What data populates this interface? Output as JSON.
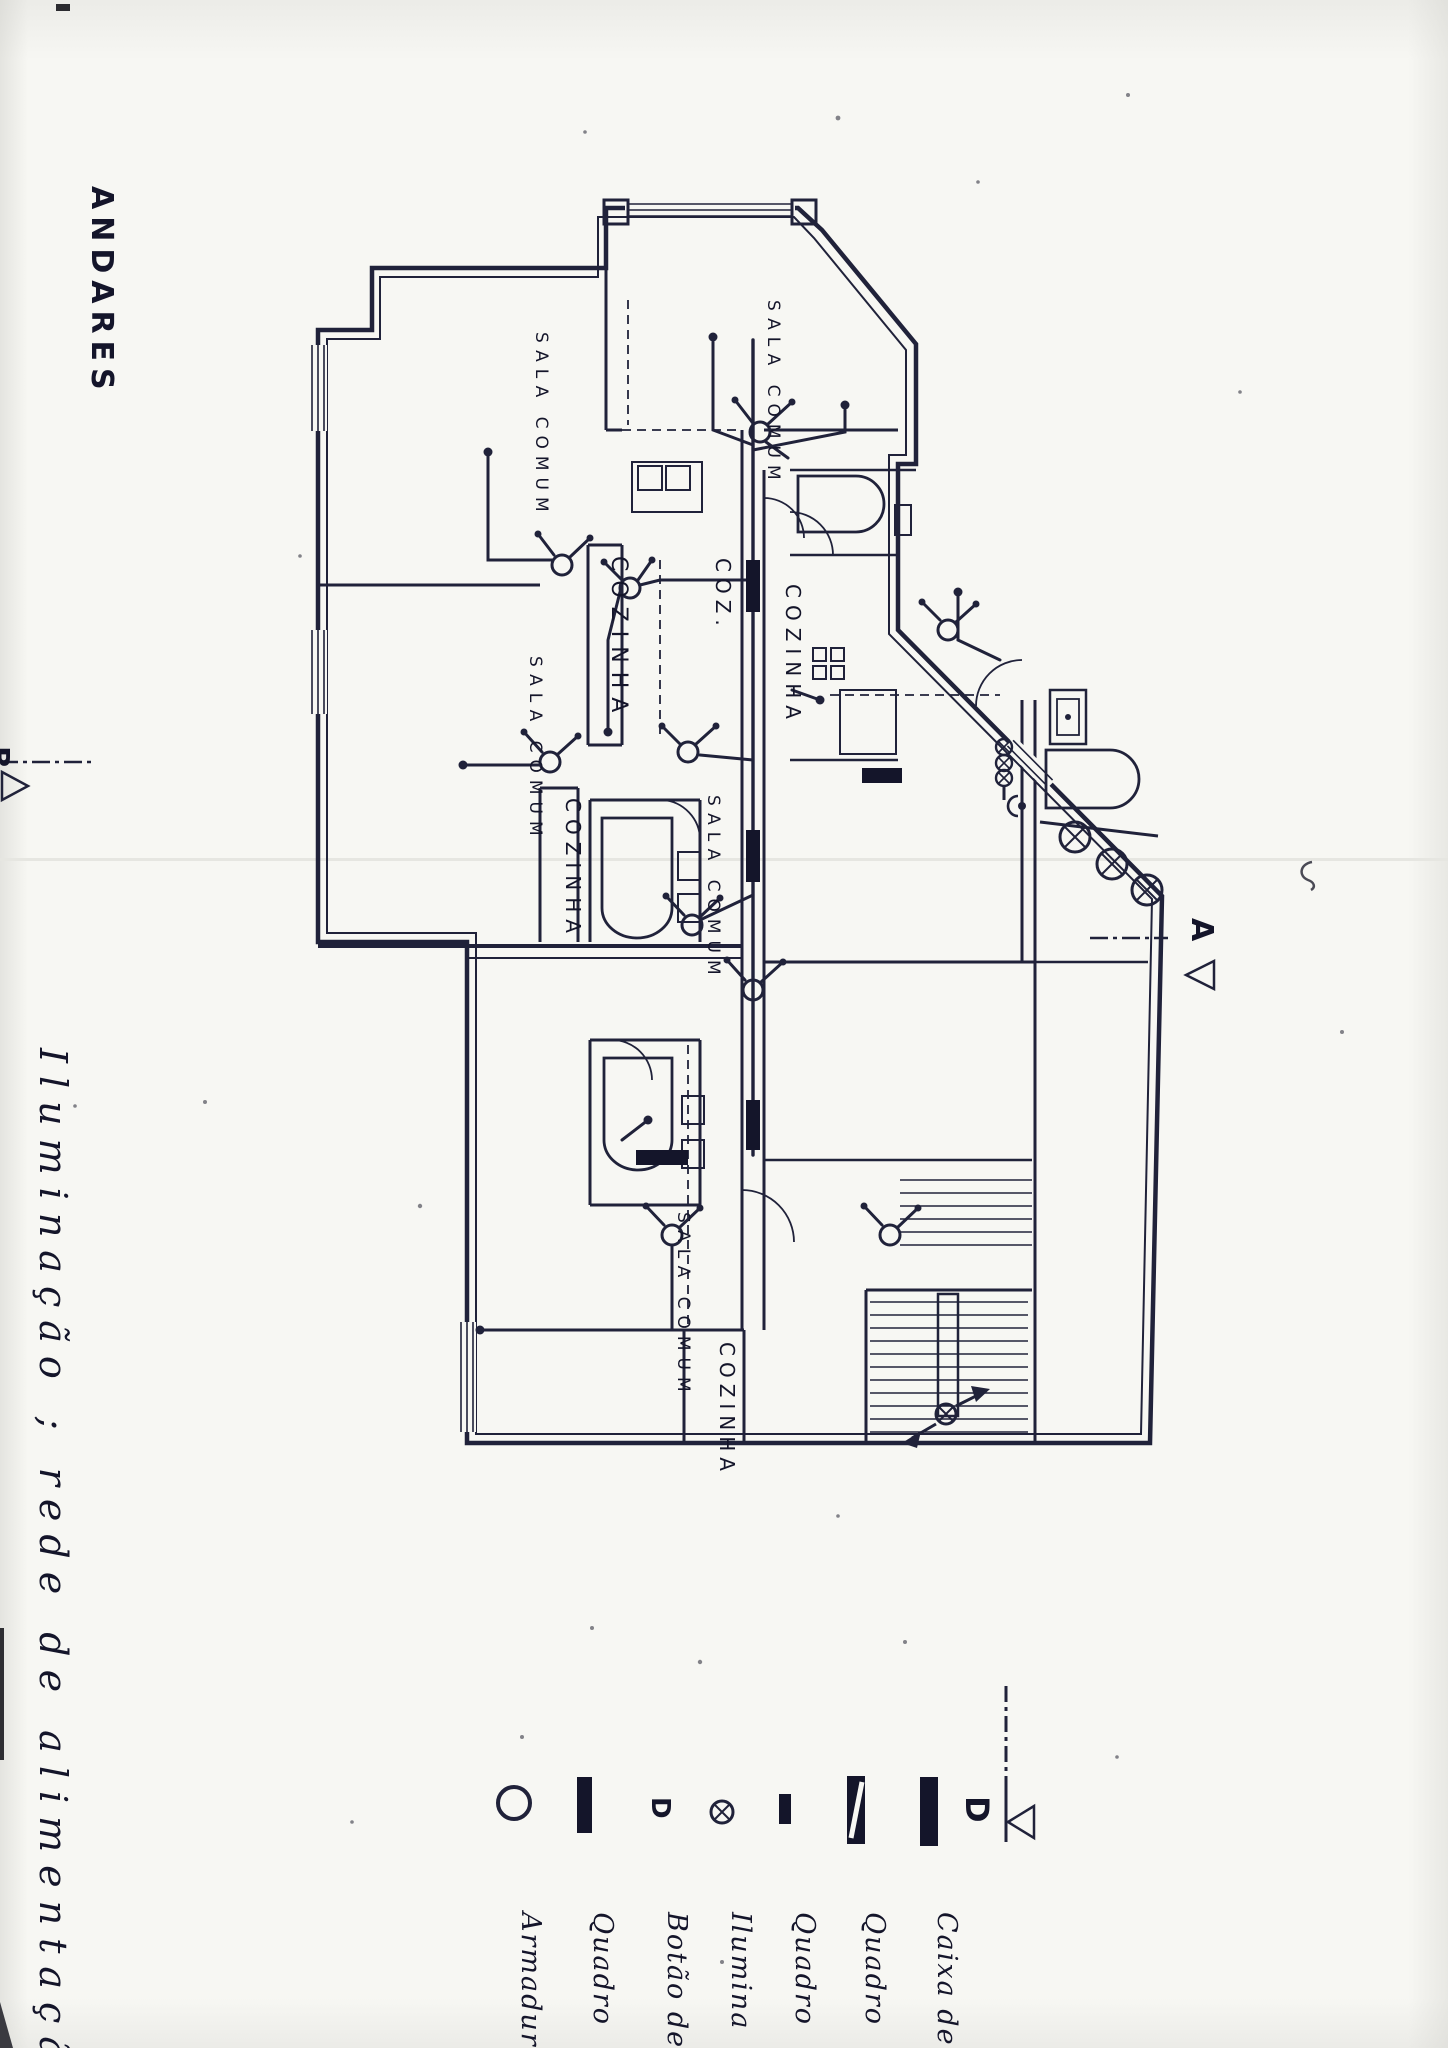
{
  "document": {
    "title": "ANDARES",
    "handwritten_note": "Iluminação ; rede de alimentação"
  },
  "plan": {
    "sala_labels": [
      "SALA COMUM",
      "SALA COMUM",
      "SALA COMUM",
      "SALA COMUM",
      "SALA COMUM"
    ],
    "cozinha_labels": [
      "COZINHA",
      "COZINHA",
      "COZINHA",
      "COZINHA"
    ],
    "coz_partial": "COZ.",
    "section_marker_a": "A",
    "section_marker_b": "B"
  },
  "legend": {
    "entries": [
      {
        "symbol": "armadura-circle-icon",
        "label": "Armadura"
      },
      {
        "symbol": "quadro-bar-icon",
        "label": "Quadro"
      },
      {
        "symbol": "botao-d-icon",
        "label": "Botão de"
      },
      {
        "symbol": "iluminacao-crossed-circle-icon",
        "label": "Ilumina"
      },
      {
        "symbol": "quadro-small-bar-icon",
        "label": "Quadro"
      },
      {
        "symbol": "quadro-striped-bar-icon",
        "label": "Quadro"
      },
      {
        "symbol": "caixa-thick-bar-icon",
        "label": "Caixa de"
      }
    ],
    "section_marker_d": "D"
  }
}
